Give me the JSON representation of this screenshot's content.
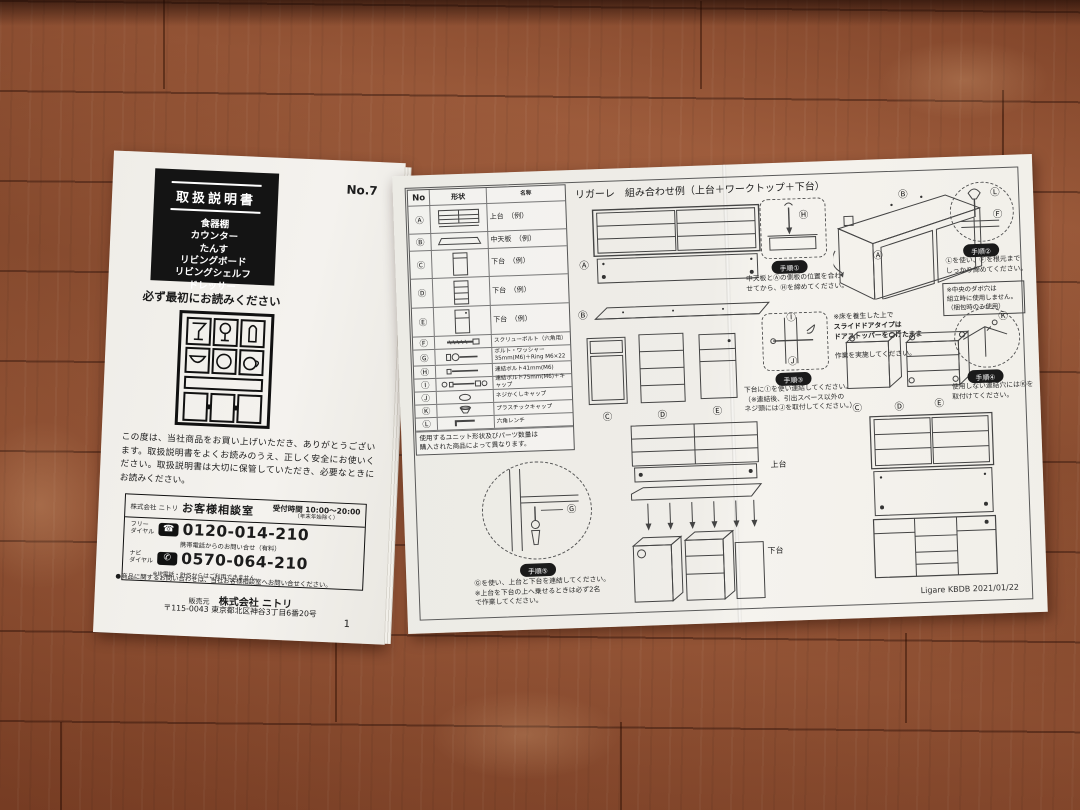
{
  "left_booklet": {
    "doc_number": "No.7",
    "title": "取扱説明書",
    "product_list": "食器棚\nカウンター\nたんす\nリビングボード\nリビングシェルフ\nドレッサー",
    "read_first": "必ず最初にお読みください",
    "intro_text": "この度は、当社商品をお買い上げいただき、ありがとうございます。取扱説明書をよくお読みのうえ、正しく安全にお使いください。取扱説明書は大切に保管していただき、必要なときにお読みください。",
    "contact_box": {
      "company": "株式会社 ニトリ",
      "dept": "お客様相談室",
      "hours_label": "受付時間 10:00～20:00",
      "hours_note": "（年末年始除く）",
      "free_dial_label": "フリー\nダイヤル",
      "free_dial_number": "0120-014-210",
      "mobile_note": "携帯電話からのお問い合せ（有料）",
      "navi_dial_label": "ナビ\nダイヤル",
      "navi_dial_number": "0570-064-210",
      "ip_note": "※IP電話・PHSからはご利用できません。",
      "inquiry_note": "●商品に関するお問い合わせは、当社お客様相談室へお問い合せください。"
    },
    "seller_label": "販売元",
    "seller_name": "株式会社 ニトリ",
    "seller_address": "〒115-0043 東京都北区神谷3丁目6番20号",
    "page_number": "1"
  },
  "icons": {
    "free_dial": "☎",
    "navi_dial": "✆"
  },
  "right_sheet": {
    "title": "リガーレ　組み合わせ例（上台＋ワークトップ＋下台）",
    "parts_table": {
      "headers": {
        "no": "No",
        "shape": "形状",
        "name": "名称"
      },
      "rows": [
        {
          "no": "Ⓐ",
          "name": "上台　（例）"
        },
        {
          "no": "Ⓑ",
          "name": "中天板　（例）"
        },
        {
          "no": "Ⓒ",
          "name": "下台　（例）"
        },
        {
          "no": "Ⓓ",
          "name": "下台　（例）"
        },
        {
          "no": "Ⓔ",
          "name": "下台　（例）"
        },
        {
          "no": "Ⓕ",
          "name": "スクリューボルト（六角用）"
        },
        {
          "no": "Ⓖ",
          "name": "ボルト・ワッシャー\n35mm(M6)＋Ring M6×22"
        },
        {
          "no": "Ⓗ",
          "name": "連結ボルト41mm(M6)"
        },
        {
          "no": "Ⓘ",
          "name": "連結ボルト75mm(M6)＋キャップ"
        },
        {
          "no": "Ⓙ",
          "name": "ネジかくしキャップ"
        },
        {
          "no": "Ⓚ",
          "name": "プラスチックキャップ"
        },
        {
          "no": "Ⓛ",
          "name": "六角レンチ"
        }
      ],
      "footer_note": "使用するユニット形状及びパーツ数量は\n購入された商品によって異なります。"
    },
    "labels": {
      "a": "Ⓐ",
      "b": "Ⓑ",
      "c": "Ⓒ",
      "d": "Ⓓ",
      "e": "Ⓔ",
      "f": "Ⓕ",
      "g": "Ⓖ",
      "h": "Ⓗ",
      "i": "Ⓘ",
      "j": "Ⓙ",
      "k": "Ⓚ",
      "l": "Ⓛ",
      "upper_unit": "上台",
      "lower_unit": "下台"
    },
    "steps": {
      "step1": {
        "badge": "手順①",
        "text": "中天板とⒶの側板の位置を合わ\nせてから、Ⓗを締めてください。"
      },
      "step2": {
        "badge": "手順②",
        "text": "Ⓛを使い、Ⓕを根元まで\nしっかり締めてください。",
        "note": "※中央のダボ穴は\n組立時に使用しません。\n（梱包時のみ使用）"
      },
      "step3": {
        "badge": "手順③",
        "text": "下台にⒾを使い連結してください。\n（※連結後、引出スペース以外の\nネジ頭にはⒿを取付してください。）"
      },
      "step4": {
        "badge": "手順④",
        "text": "使用しない連結穴にはⓀを\n取付けてください。"
      },
      "step5": {
        "badge": "手順⑤",
        "text": "Ⓖを使い、上台と下台を連結してください。\n※上台を下台の上へ乗せるときは必ず2名\nで作業してください。"
      }
    },
    "floor_note": {
      "lead": "※床を養生した上で",
      "bold": "スライドドアタイプは\nドアストッパーをつけたまま",
      "tail": "作業を実施してください。"
    },
    "footer_code": "Ligare KBDB 2021/01/22"
  }
}
